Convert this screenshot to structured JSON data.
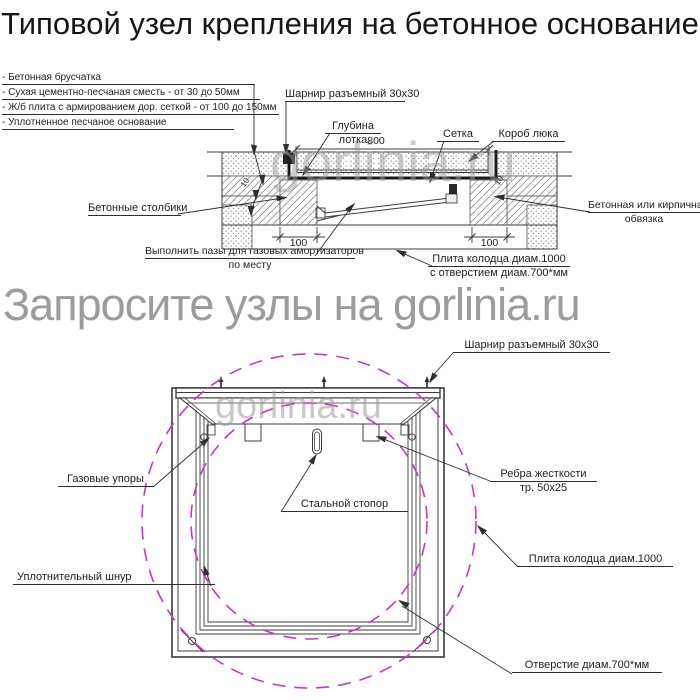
{
  "title": {
    "line1": "Типовой узел крепления",
    "line2": "на бетонное основание"
  },
  "watermarks": {
    "banner": "Запросите узлы на gorlinia.ru",
    "brand": "gorlinia.ru"
  },
  "section": {
    "legend": [
      "- Бетонная брусчатка",
      "- Сухая цементно-песчаная сместь - от 30 до 50мм",
      "- Ж/б плита с армированием дор. сеткой - от 100 до 150мм",
      "- Уплотненное песчаное основание"
    ],
    "labels": {
      "hinge": "Шарнир разъемный 30х30",
      "depth1": "Глубина",
      "depth2": "лотка",
      "mesh": "Сетка",
      "box": "Короб люка",
      "posts": "Бетонные столбики",
      "grooves1": "Выполнить пазы для газовых амортизаторов",
      "grooves2": "по месту",
      "plate1": "Плита колодца диам.1000",
      "plate2": "с отверстием диам.700*мм",
      "edging1": "Бетонная или кирпичная",
      "edging2": "обвязка"
    },
    "dims": {
      "width": "800",
      "left": "100",
      "right": "100",
      "ten": "10"
    }
  },
  "plan": {
    "labels": {
      "hinge": "Шарнир разъемный 30х30",
      "gas": "Газовые упоры",
      "stopper": "Стальной стопор",
      "ribs1": "Ребра жесткости",
      "ribs2": "тр. 50х25",
      "plate": "Плита колодца диам.1000",
      "hole": "Отверстие диам.700*мм",
      "seal": "Уплотнительный шнур"
    }
  },
  "colors": {
    "dashed_circle": "#c438c4",
    "watermark": "#9c9c9c",
    "line": "#3c3c3c"
  }
}
